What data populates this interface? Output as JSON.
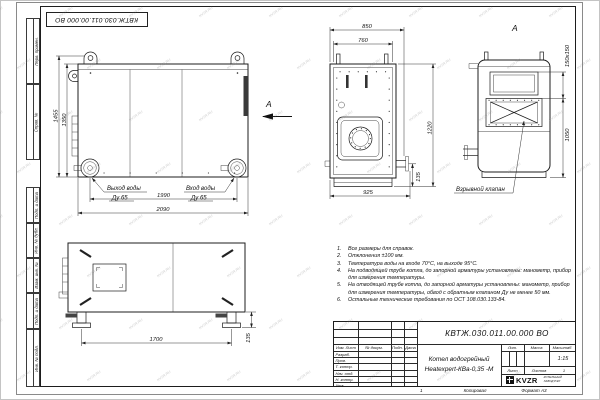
{
  "watermark": "KVZR.RU",
  "stamp_top": "КВТЖ.030.011.00.000 ВО",
  "margin_fields": [
    "Перв. примен.",
    "Справ. №",
    "Подп. и дата",
    "Инв. № дубл.",
    "Взам. инв. №",
    "Подп. и дата",
    "Инв. № подл."
  ],
  "views": {
    "arrow_label": "А",
    "side": {
      "dim_height_outer": "1455",
      "dim_height_inner": "1350",
      "dim_span_ports": "1990",
      "dim_width_overall": "2090",
      "outlet_line1": "Выход воды",
      "outlet_line2": "Ду 65",
      "inlet_line1": "Вход воды",
      "inlet_line2": "Ду 65"
    },
    "front": {
      "dim_width_overall": "850",
      "dim_width_inner": "760",
      "dim_height": "1220",
      "dim_width_base": "925",
      "dim_pipe_height": "135"
    },
    "rear": {
      "label": "А",
      "dim_valve": "150х150",
      "dim_height": "1050",
      "valve_label": "Взрывной клапан"
    },
    "back": {
      "dim_legs": "1700",
      "dim_foot": "135"
    }
  },
  "notes": [
    {
      "n": "1.",
      "t": "Все размеры для справок."
    },
    {
      "n": "2.",
      "t": "Отклонения ±100 мм."
    },
    {
      "n": "3.",
      "t": "Температура воды на входе 70°С, на выходе 95°С."
    },
    {
      "n": "4.",
      "t": "На подводящей трубе котла, до запорной арматуры установлены: манометр, прибор для измерения температуры."
    },
    {
      "n": "5.",
      "t": "На отводящей трубе котла, до запорной арматуры установлены: манометр, прибор для измерения температуры, обвод с обратным клапаном Ду не менее 50 мм."
    },
    {
      "n": "6.",
      "t": "Остальные технические требования по ОСТ 108.030.133-84."
    }
  ],
  "title_block": {
    "doc_number": "КВТЖ.030.011.00.000 ВО",
    "product_line1": "Котел водогрейный",
    "product_line2": "Heatexpert-КВа-0,35 -М",
    "col_izm": "Изм. Лист",
    "col_doc": "№ докум.",
    "col_sign": "Подп.",
    "col_date": "Дата",
    "rows": [
      "Разраб.",
      "Пров.",
      "Т. контр.",
      "Нач. отд.",
      "Н. контр.",
      "Утв."
    ],
    "lit": "Лит.",
    "mass": "Масса",
    "scale": "Масштаб",
    "scale_value": "1:15",
    "sheet": "Лист",
    "sheets": "Листов",
    "sheets_value": "1",
    "logo": "KVZR",
    "company_line1": "КОТЕЛЬНЫЙ",
    "company_line2": "ЗАВОД РЭП",
    "footer_num": "1",
    "footer_copy": "Копировал",
    "footer_format": "Формат А3"
  }
}
